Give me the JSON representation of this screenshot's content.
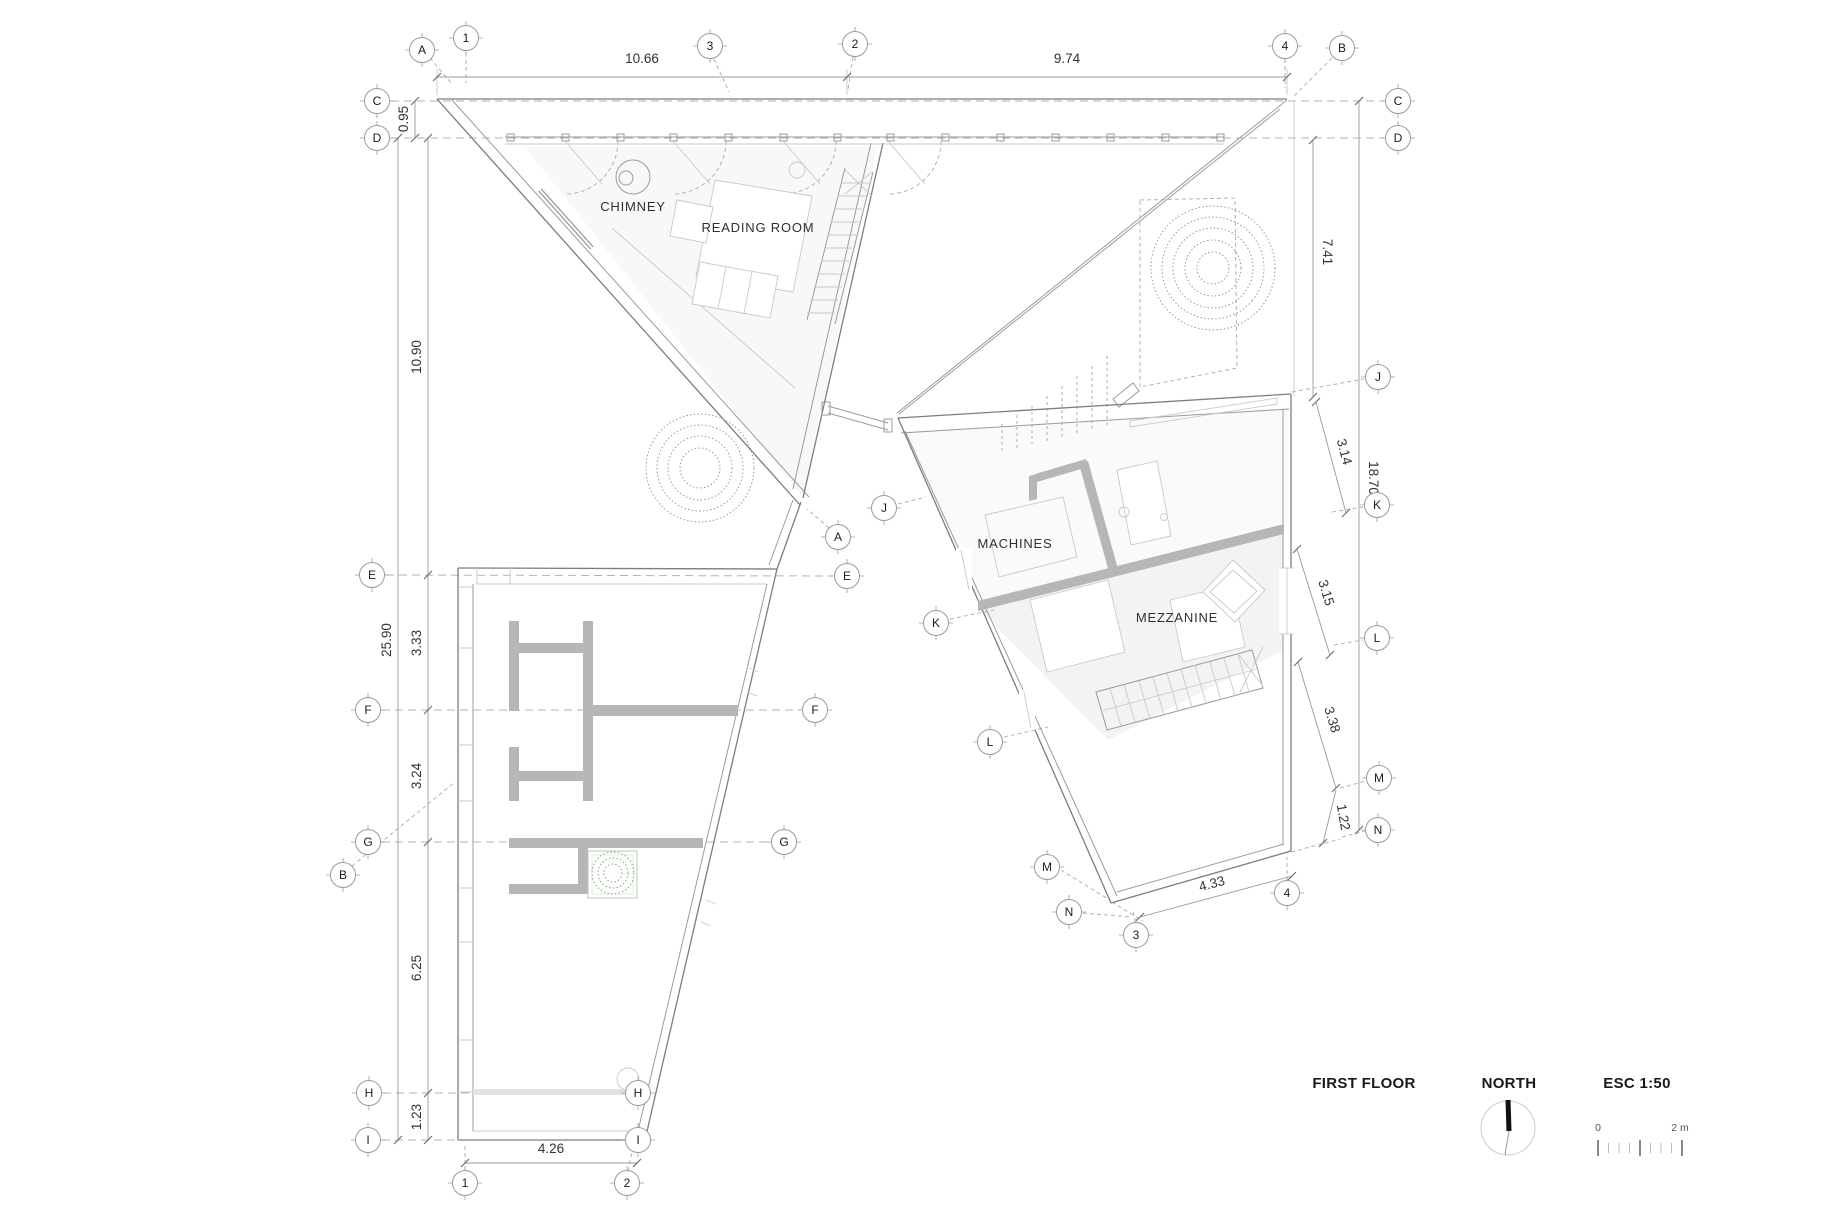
{
  "title_block": {
    "floor_label": "FIRST FLOOR",
    "north_label": "NORTH",
    "scale_label": "ESC 1:50",
    "scalebar_start": "0",
    "scalebar_end": "2 m"
  },
  "rooms": {
    "chimney": "CHIMNEY",
    "reading_room": "READING ROOM",
    "machines": "MACHINES",
    "mezzanine": "MEZZANINE"
  },
  "grid_markers": {
    "A": "A",
    "B": "B",
    "C": "C",
    "D": "D",
    "E": "E",
    "F": "F",
    "G": "G",
    "H": "H",
    "I": "I",
    "J": "J",
    "K": "K",
    "L": "L",
    "M": "M",
    "N": "N",
    "n1": "1",
    "n2": "2",
    "n3": "3",
    "n4": "4"
  },
  "dimensions": {
    "top_span_left": "10.66",
    "top_span_right": "9.74",
    "left_c_to_d": "0.95",
    "left_d_to_e": "10.90",
    "left_total": "25.90",
    "left_e_to_f": "3.33",
    "left_f_to_g": "3.24",
    "left_g_to_h": "6.25",
    "left_h_to_i": "1.23",
    "bottom_span": "4.26",
    "right_d_to_j": "7.41",
    "right_total": "18.70",
    "right_j_to_k": "3.14",
    "right_k_to_l": "3.15",
    "right_l_to_m": "3.38",
    "right_m_to_n": "1.22",
    "bottom_right_span": "4.33"
  },
  "colors": {
    "wall-fill": "#b6b6b6",
    "line-strong": "#7d7d7d",
    "line": "#9b9b9b",
    "line-light": "#c9c9c9",
    "dash": "#b3b3b3",
    "tint": "#f6f6f6",
    "text": "#333333",
    "planter": "#aecfae",
    "needle": "#111111"
  }
}
